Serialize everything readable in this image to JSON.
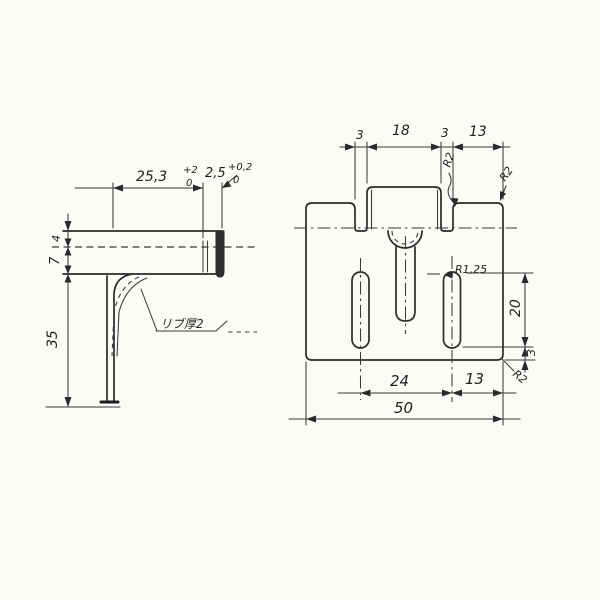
{
  "drawing": {
    "paper_color": "#fbfbf8",
    "ink_color": "#2a2a2a",
    "side_view": {
      "dim_flange_length": "25,3",
      "dim_flange_tol_upper": "+2",
      "dim_flange_tol_lower": "0",
      "dim_lip": "2,5",
      "dim_lip_tol_upper": "+0,2",
      "dim_lip_tol_lower": "0",
      "dim_top_offset": "4",
      "dim_flange_height": "7",
      "dim_leg_height": "35",
      "rib_note": "リブ厚2"
    },
    "front_view": {
      "dim_gap_left": "3",
      "dim_mid_tab_width": "18",
      "dim_gap_right": "3",
      "dim_right_tab_width": "13",
      "dim_slot_length": "20",
      "dim_bottom_margin": "3",
      "dim_slot_spacing": "24",
      "dim_slot_to_edge": "13",
      "dim_overall_width": "50",
      "radius_notch": "R2",
      "radius_tab_corner": "R2",
      "radius_bottom_corner": "R2",
      "radius_slot": "R1,25"
    }
  }
}
